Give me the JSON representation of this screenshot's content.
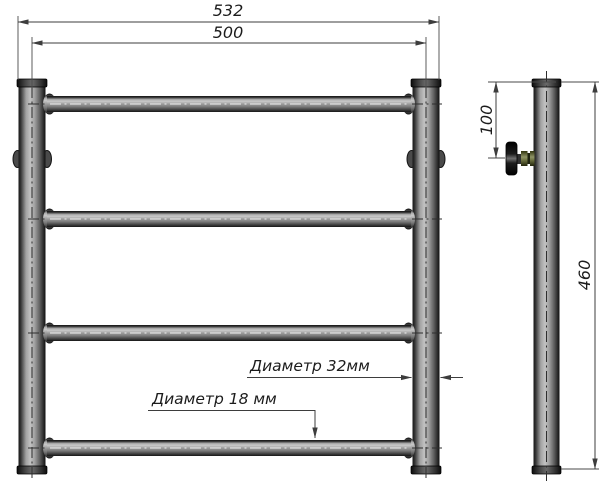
{
  "page": {
    "background": "#ffffff",
    "line_color": "#3d3d3d",
    "text_color": "#1c1c1c"
  },
  "colors": {
    "pipe_dark": "#161616",
    "pipe_mid": "#9e9e9e",
    "pipe_light": "#c9c9c9",
    "valve_olive": "#8f9465",
    "valve_knob": "#0a0a0a"
  },
  "dimensions": {
    "total_width_mm": "532",
    "axis_width_mm": "500",
    "height_mm": "460",
    "valve_offset_mm": "100"
  },
  "labels": {
    "post_diameter": "Диаметр 32мм",
    "rung_diameter": "Диаметр 18 мм"
  }
}
